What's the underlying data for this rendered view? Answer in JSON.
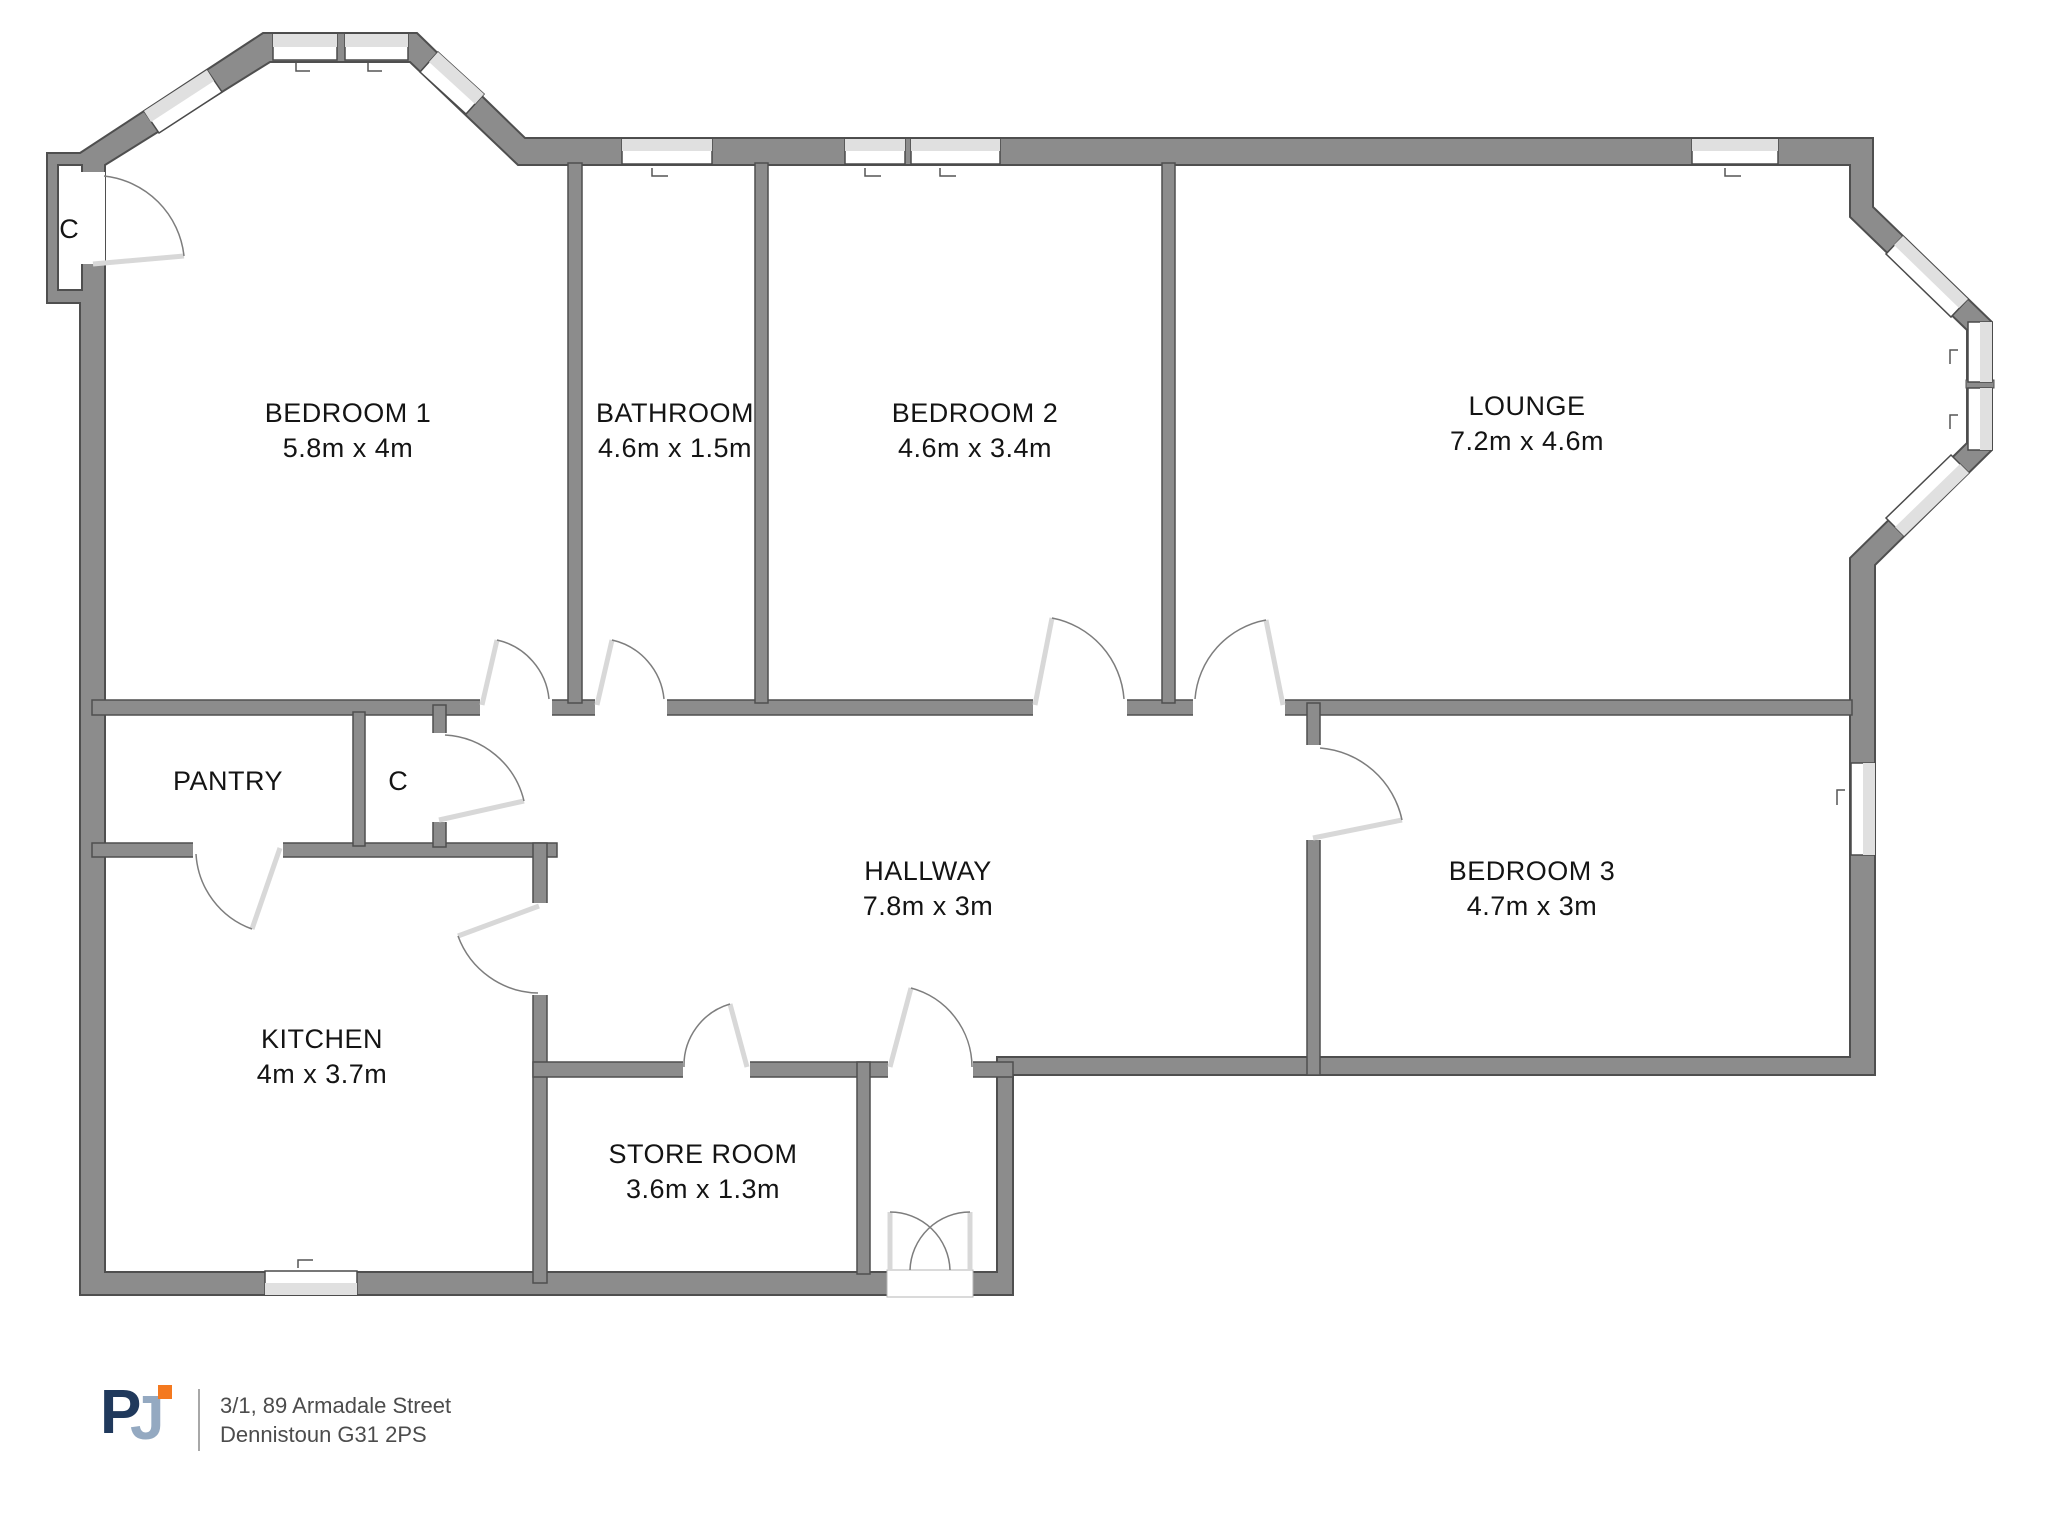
{
  "rooms": {
    "bedroom1": {
      "name": "BEDROOM 1",
      "dims": "5.8m x 4m"
    },
    "bathroom": {
      "name": "BATHROOM",
      "dims": "4.6m x 1.5m"
    },
    "bedroom2": {
      "name": "BEDROOM 2",
      "dims": "4.6m x 3.4m"
    },
    "lounge": {
      "name": "LOUNGE",
      "dims": "7.2m x 4.6m"
    },
    "pantry": {
      "name": "PANTRY"
    },
    "hallway": {
      "name": "HALLWAY",
      "dims": "7.8m x 3m"
    },
    "bedroom3": {
      "name": "BEDROOM 3",
      "dims": "4.7m x 3m"
    },
    "kitchen": {
      "name": "KITCHEN",
      "dims": "4m x 3.7m"
    },
    "store_room": {
      "name": "STORE ROOM",
      "dims": "3.6m x 1.3m"
    }
  },
  "closets": {
    "bedroom1_closet": "C",
    "hall_closet": "C"
  },
  "footer": {
    "logo": {
      "p": "P",
      "j": "J"
    },
    "address_line1": "3/1, 89 Armadale Street",
    "address_line2": "Dennistoun G31 2PS"
  },
  "colors": {
    "wall": "#8c8c8c",
    "wall_outline": "#4f4f4f",
    "window_band": "#e0e0e0",
    "logo_navy": "#20395c",
    "logo_slate": "#94a9c1",
    "logo_orange": "#f4791f"
  }
}
